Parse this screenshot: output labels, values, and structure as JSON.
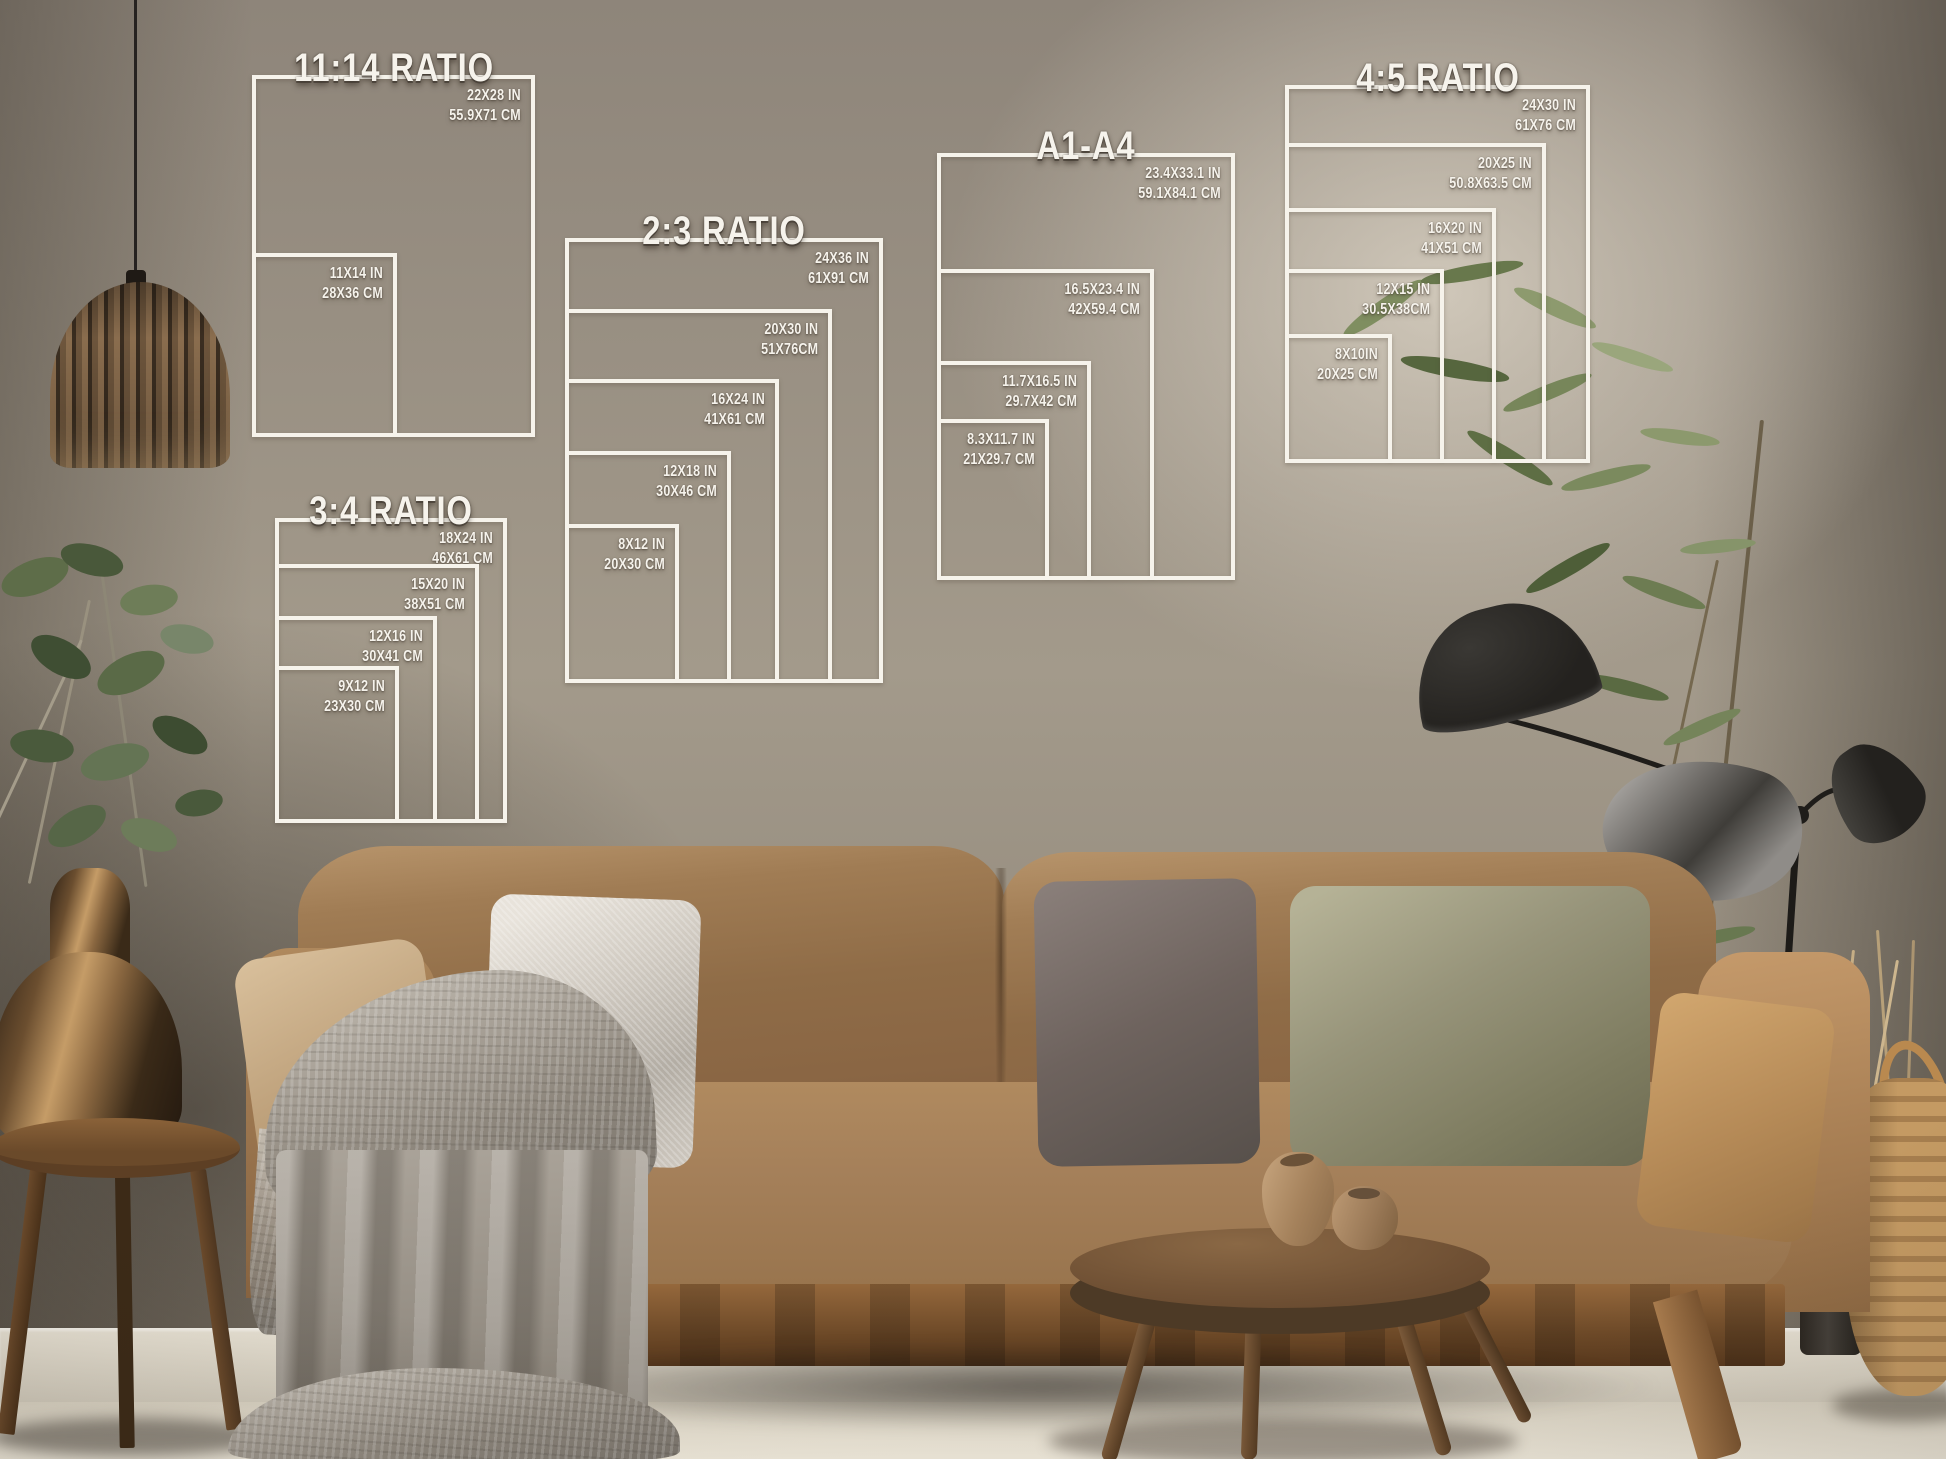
{
  "ratio_charts": [
    {
      "title": "11:14 RATIO",
      "sizes": [
        {
          "inches": "22X28 IN",
          "cm": "55.9X71 CM"
        },
        {
          "inches": "11X14 IN",
          "cm": "28X36 CM"
        }
      ]
    },
    {
      "title": "2:3 RATIO",
      "sizes": [
        {
          "inches": "24X36 IN",
          "cm": "61X91 CM"
        },
        {
          "inches": "20X30 IN",
          "cm": "51X76CM"
        },
        {
          "inches": "16X24 IN",
          "cm": "41X61 CM"
        },
        {
          "inches": "12X18 IN",
          "cm": "30X46 CM"
        },
        {
          "inches": "8X12 IN",
          "cm": "20X30 CM"
        }
      ]
    },
    {
      "title": "3:4 RATIO",
      "sizes": [
        {
          "inches": "18X24 IN",
          "cm": "46X61 CM"
        },
        {
          "inches": "15X20 IN",
          "cm": "38X51 CM"
        },
        {
          "inches": "12X16 IN",
          "cm": "30X41 CM"
        },
        {
          "inches": "9X12 IN",
          "cm": "23X30 CM"
        }
      ]
    },
    {
      "title": "A1-A4",
      "sizes": [
        {
          "inches": "23.4X33.1 IN",
          "cm": "59.1X84.1 CM"
        },
        {
          "inches": "16.5X23.4 IN",
          "cm": "42X59.4 CM"
        },
        {
          "inches": "11.7X16.5 IN",
          "cm": "29.7X42 CM"
        },
        {
          "inches": "8.3X11.7 IN",
          "cm": "21X29.7 CM"
        }
      ]
    },
    {
      "title": "4:5 RATIO",
      "sizes": [
        {
          "inches": "24X30 IN",
          "cm": "61X76 CM"
        },
        {
          "inches": "20X25 IN",
          "cm": "50.8X63.5 CM"
        },
        {
          "inches": "16X20 IN",
          "cm": "41X51 CM"
        },
        {
          "inches": "12X15 IN",
          "cm": "30.5X38CM"
        },
        {
          "inches": "8X10IN",
          "cm": "20X25 CM"
        }
      ]
    }
  ],
  "colors": {
    "line_white": "#f6f3eb",
    "text_white": "#f6f3ec",
    "wall": "#a39a8b",
    "wall_dark": "#8e857a",
    "floor": "#ece6d8",
    "baseboard": "#e6e0d2",
    "sofa": "#96714b",
    "sofa_light": "#bb9569",
    "sofa_wood": "#7a5330",
    "blanket": "#a59e94",
    "pillow_tan": "#c9ac87",
    "pillow_silver": "#cfc9c0",
    "pillow_dark": "#6e635e",
    "pillow_sage": "#97947a",
    "brass": "#b08a58",
    "walnut": "#6e4f33",
    "jute": "#bf9a68",
    "leaf_green": "#6c7b51",
    "lamp_black": "#24221f",
    "metal_gray": "#8f8c88"
  }
}
